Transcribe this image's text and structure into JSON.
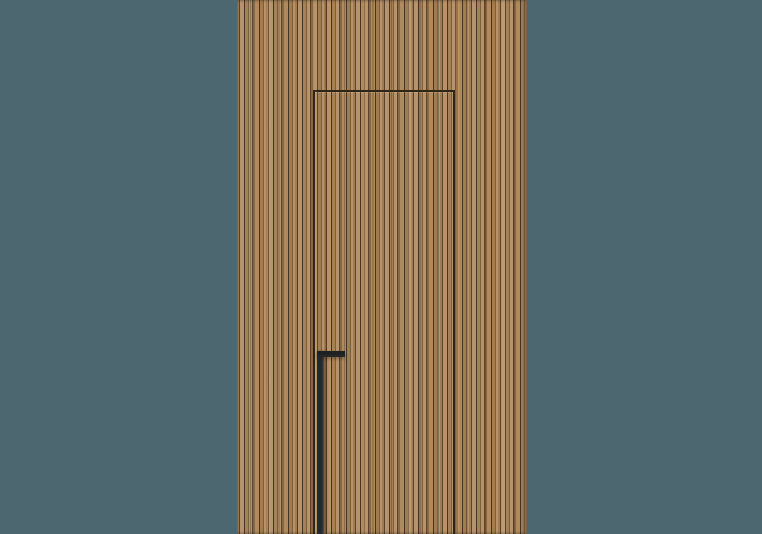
{
  "scene": {
    "type": "product-render",
    "subject": "concealed flush door with vertical wood slat cladding and long black handle"
  },
  "colors": {
    "background": "#4c6770",
    "wood_light": "#b7926a",
    "wood_mid": "#a07c52",
    "wood_dark": "#7c5e3a",
    "wood_groove": "#5a452c",
    "wood_groove_deep": "#463521",
    "door_gap": "#2e2517",
    "handle": "#26292b"
  }
}
